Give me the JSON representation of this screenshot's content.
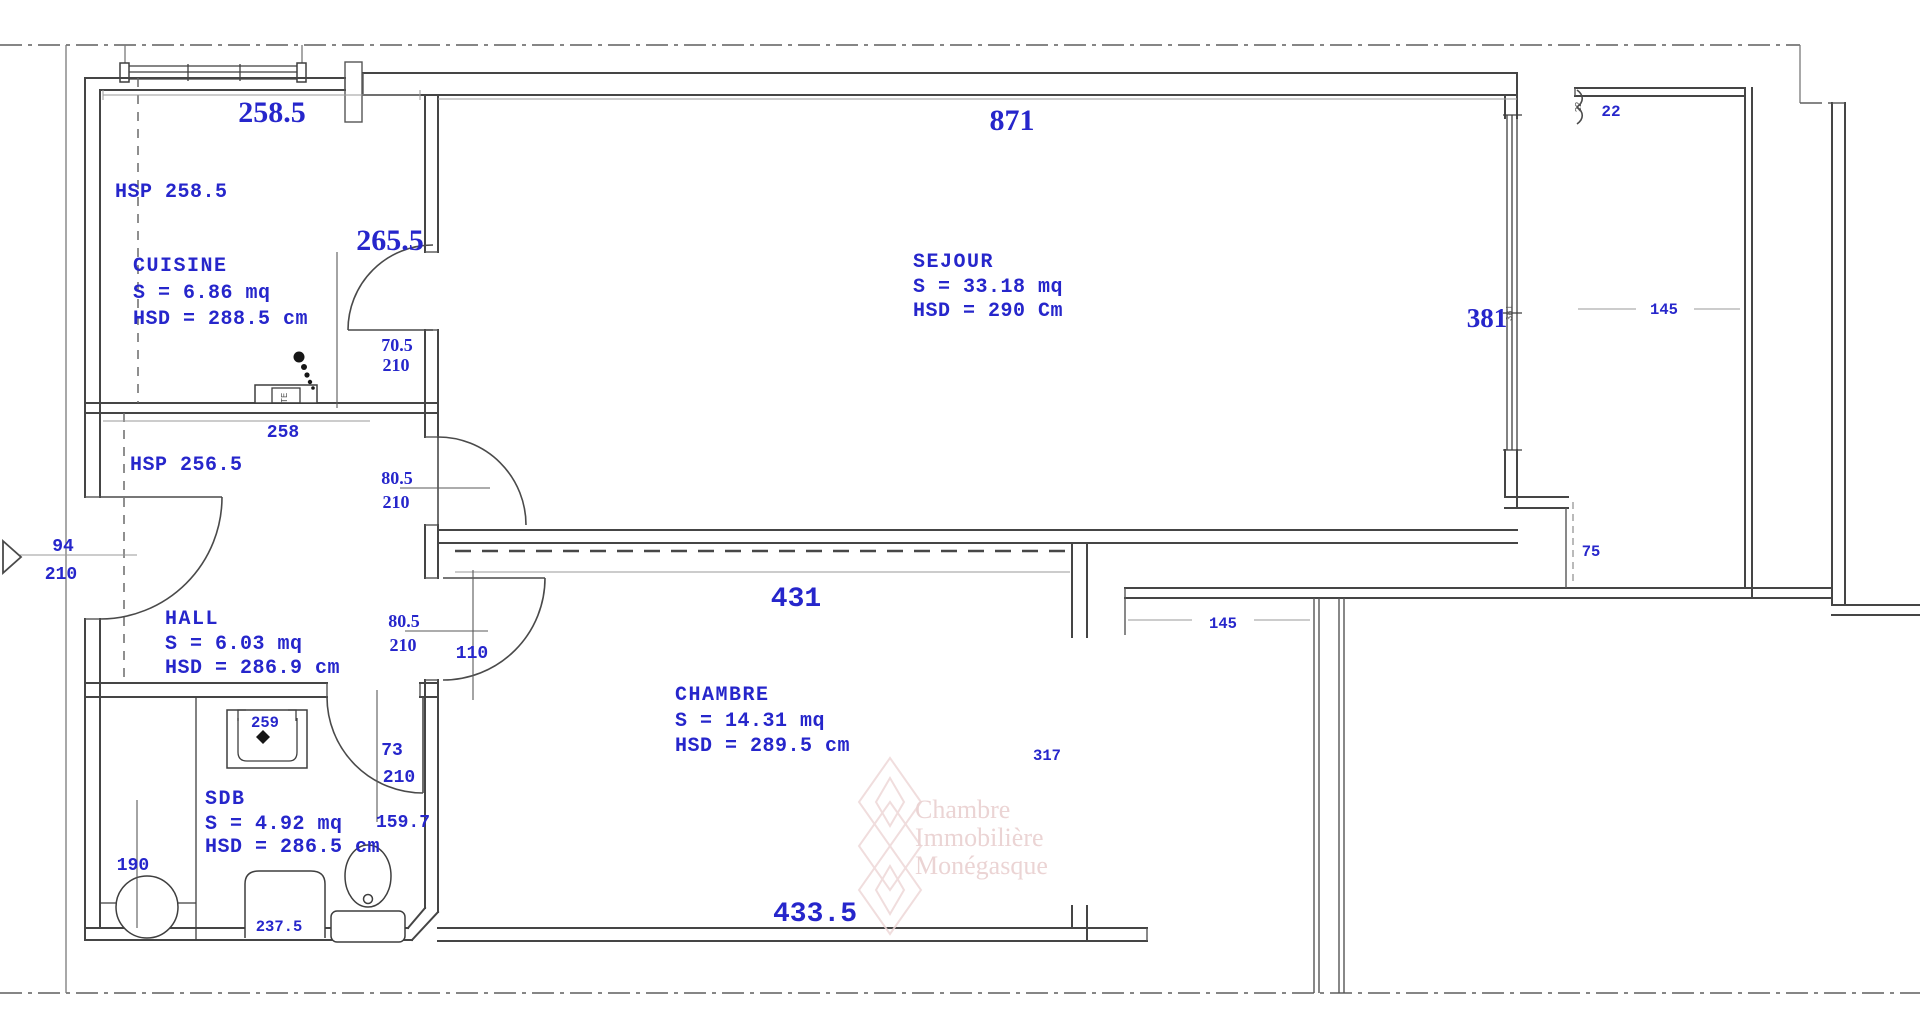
{
  "plan_title": "Apartment floor plan",
  "rooms": {
    "cuisine": {
      "name": "CUISINE",
      "area": "S = 6.86 mq",
      "hsd": "HSD = 288.5 cm",
      "hsp": "HSP 258.5"
    },
    "sejour": {
      "name": "SEJOUR",
      "area": "S = 33.18 mq",
      "hsd": "HSD = 290 Cm"
    },
    "hall": {
      "name": "HALL",
      "area": "S = 6.03 mq",
      "hsd": "HSD = 286.9 cm",
      "hsp": "HSP 256.5"
    },
    "chambre": {
      "name": "CHAMBRE",
      "area": "S = 14.31 mq",
      "hsd": "HSD = 289.5 cm"
    },
    "sdb": {
      "name": "SDB",
      "area": "S = 4.92 mq",
      "hsd": "HSD = 286.5 cm"
    }
  },
  "dims": {
    "d258_5": "258.5",
    "d265_5": "265.5",
    "d871": "871",
    "d381": "381",
    "d381_small": "381",
    "d22": "22",
    "d22_small": "22",
    "d145_balcony": "145",
    "d75": "75",
    "d70_5": "70.5",
    "d70_5_h": "210",
    "d258": "258",
    "d94": "94",
    "d94_h": "210",
    "d80_5_a": "80.5",
    "d80_5_a_h": "210",
    "d80_5_b": "80.5",
    "d80_5_b_h": "210",
    "d110": "110",
    "d431": "431",
    "d433_5": "433.5",
    "d317": "317",
    "d145_terrace": "145",
    "d73": "73",
    "d73_h": "210",
    "d159_7": "159.7",
    "d190": "190",
    "d259": "259",
    "d237_5": "237.5",
    "te": "TE"
  },
  "watermark": {
    "line1": "Chambre",
    "line2": "Immobilière",
    "line3": "Monégasque"
  },
  "colors": {
    "dim_text": "#2626cb",
    "wall": "#454545",
    "thin_line": "#9a9a9a",
    "watermark_pink": "#e8cdcd"
  }
}
